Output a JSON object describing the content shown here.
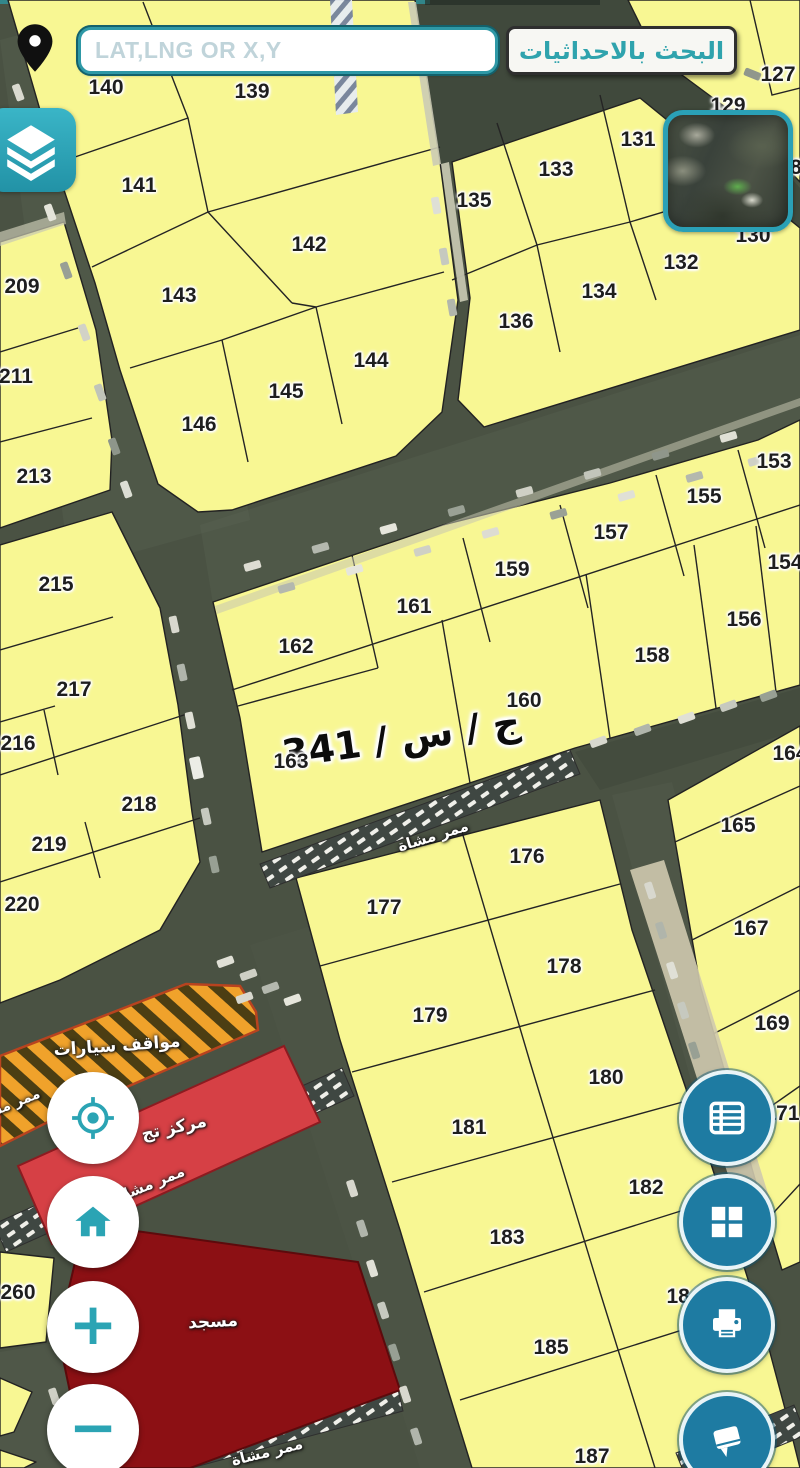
{
  "search": {
    "placeholder": "LAT,LNG OR X,Y",
    "button_label": "البحث بالاحداثيات"
  },
  "map": {
    "street_label": {
      "text": "ج / س / 341",
      "x": 401,
      "y": 738,
      "rot": -8
    },
    "parcels": [
      {
        "n": "140",
        "x": 106,
        "y": 88
      },
      {
        "n": "139",
        "x": 252,
        "y": 92
      },
      {
        "n": "127",
        "x": 778,
        "y": 75
      },
      {
        "n": "129",
        "x": 728,
        "y": 106
      },
      {
        "n": "8",
        "x": 796,
        "y": 168
      },
      {
        "n": "130",
        "x": 753,
        "y": 236
      },
      {
        "n": "141",
        "x": 139,
        "y": 186
      },
      {
        "n": "135",
        "x": 474,
        "y": 201
      },
      {
        "n": "133",
        "x": 556,
        "y": 170
      },
      {
        "n": "131",
        "x": 638,
        "y": 140
      },
      {
        "n": "132",
        "x": 681,
        "y": 263
      },
      {
        "n": "134",
        "x": 599,
        "y": 292
      },
      {
        "n": "136",
        "x": 516,
        "y": 322
      },
      {
        "n": "142",
        "x": 309,
        "y": 245
      },
      {
        "n": "143",
        "x": 179,
        "y": 296
      },
      {
        "n": "144",
        "x": 371,
        "y": 361
      },
      {
        "n": "145",
        "x": 286,
        "y": 392
      },
      {
        "n": "146",
        "x": 199,
        "y": 425
      },
      {
        "n": "209",
        "x": 22,
        "y": 287
      },
      {
        "n": "211",
        "x": 16,
        "y": 377
      },
      {
        "n": "213",
        "x": 34,
        "y": 477
      },
      {
        "n": "215",
        "x": 56,
        "y": 585
      },
      {
        "n": "217",
        "x": 74,
        "y": 690
      },
      {
        "n": "216",
        "x": 18,
        "y": 744
      },
      {
        "n": "218",
        "x": 139,
        "y": 805
      },
      {
        "n": "219",
        "x": 49,
        "y": 845
      },
      {
        "n": "220",
        "x": 22,
        "y": 905
      },
      {
        "n": "153",
        "x": 774,
        "y": 462
      },
      {
        "n": "155",
        "x": 704,
        "y": 497
      },
      {
        "n": "157",
        "x": 611,
        "y": 533
      },
      {
        "n": "159",
        "x": 512,
        "y": 570
      },
      {
        "n": "161",
        "x": 414,
        "y": 607
      },
      {
        "n": "162",
        "x": 296,
        "y": 647
      },
      {
        "n": "163",
        "x": 291,
        "y": 762
      },
      {
        "n": "154",
        "x": 785,
        "y": 563
      },
      {
        "n": "156",
        "x": 744,
        "y": 620
      },
      {
        "n": "158",
        "x": 652,
        "y": 656
      },
      {
        "n": "160",
        "x": 524,
        "y": 701
      },
      {
        "n": "164",
        "x": 790,
        "y": 754
      },
      {
        "n": "165",
        "x": 738,
        "y": 826
      },
      {
        "n": "167",
        "x": 751,
        "y": 929
      },
      {
        "n": "169",
        "x": 772,
        "y": 1024
      },
      {
        "n": "171",
        "x": 782,
        "y": 1114
      },
      {
        "n": "176",
        "x": 527,
        "y": 857
      },
      {
        "n": "177",
        "x": 384,
        "y": 908
      },
      {
        "n": "178",
        "x": 564,
        "y": 967
      },
      {
        "n": "179",
        "x": 430,
        "y": 1016
      },
      {
        "n": "180",
        "x": 606,
        "y": 1078
      },
      {
        "n": "181",
        "x": 469,
        "y": 1128
      },
      {
        "n": "182",
        "x": 646,
        "y": 1188
      },
      {
        "n": "183",
        "x": 507,
        "y": 1238
      },
      {
        "n": "184",
        "x": 684,
        "y": 1297
      },
      {
        "n": "185",
        "x": 551,
        "y": 1348
      },
      {
        "n": "187",
        "x": 592,
        "y": 1457
      },
      {
        "n": "260",
        "x": 18,
        "y": 1293
      }
    ],
    "area_labels": [
      {
        "text": "مواقف سيارات",
        "x": 117,
        "y": 1046,
        "rot": -4,
        "size": 17
      },
      {
        "text": "مركز تج",
        "x": 174,
        "y": 1128,
        "rot": -12,
        "size": 17
      },
      {
        "text": "مسجد",
        "x": 213,
        "y": 1322,
        "rot": -3,
        "size": 17
      },
      {
        "text": "ممر مشاة",
        "x": 433,
        "y": 836,
        "rot": -17,
        "size": 15
      },
      {
        "text": "ممر مشاة",
        "x": 150,
        "y": 1184,
        "rot": -22,
        "size": 15
      },
      {
        "text": "ممر مشاة",
        "x": 267,
        "y": 1452,
        "rot": -14,
        "size": 15
      },
      {
        "text": "ممر مشاة",
        "x": 8,
        "y": 1106,
        "rot": -22,
        "size": 14
      }
    ]
  },
  "controls": {
    "zoom_in_label": "+",
    "zoom_out_label": "−",
    "left_buttons": [
      {
        "name": "locate",
        "icon": "crosshair-locate-icon"
      },
      {
        "name": "home",
        "icon": "home-icon"
      },
      {
        "name": "zoom-in",
        "icon": "plus-icon"
      },
      {
        "name": "zoom-out",
        "icon": "minus-icon"
      }
    ],
    "right_buttons": [
      {
        "name": "parcel-list",
        "icon": "list-icon"
      },
      {
        "name": "layout-grid",
        "icon": "grid-icon"
      },
      {
        "name": "print",
        "icon": "printer-icon"
      },
      {
        "name": "guide-book",
        "icon": "book-icon"
      }
    ]
  },
  "icons_top": [
    "location-pin-icon",
    "layers-icon",
    "overview-minimap"
  ],
  "colors": {
    "parcel_fill": "#f8f793",
    "accent_teal": "#2ba4b4",
    "button_blue": "#1e7ba2",
    "road_base": "#4a5243",
    "mosque_red": "#8c1014",
    "commercial_red": "#d64045",
    "parking_orange": "#f0a22b",
    "placeholder_text": "#c0d4da",
    "search_button_text": "#2fa3ad"
  }
}
